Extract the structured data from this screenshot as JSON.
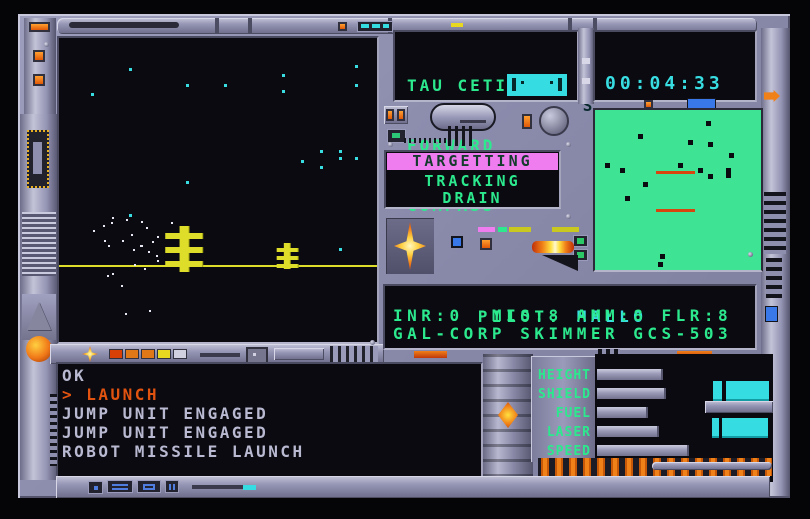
{
  "colors": {
    "metal": "#8e8eae",
    "metal_light": "#c8c8de",
    "metal_dark": "#565672",
    "panel_black": "#0a0a10",
    "green": "#2ce98e",
    "cyan": "#38dde2",
    "radar_green": "#3fe394",
    "pink": "#f07df0",
    "alert_orange": "#e35310",
    "console_gray": "#b9b9d2",
    "yellow": "#dede2a",
    "blue": "#4f7de0"
  },
  "status": {
    "location": "TAU CETI III",
    "view": "FORWARD",
    "compass_label": "COMPASS",
    "compass_heading": "S",
    "clock": "00:04:33",
    "site": "NOVIA",
    "state": "LAUNCHED"
  },
  "target": {
    "mode": "TARGETTING",
    "line1": "TRACKING",
    "line2": "DRAIN"
  },
  "pilot": {
    "label": "PILOT:",
    "name": "MALLO",
    "stats": "INR:0  MIS:8 AMM:8 FLR:8",
    "craft": "GAL-CORP SKIMMER GCS-503"
  },
  "console": {
    "lines": [
      {
        "text": "OK",
        "highlight": false
      },
      {
        "text": "> LAUNCH",
        "highlight": true
      },
      {
        "text": "JUMP UNIT ENGAGED",
        "highlight": false
      },
      {
        "text": "JUMP UNIT ENGAGED",
        "highlight": false
      },
      {
        "text": "ROBOT MISSILE LAUNCH",
        "highlight": false
      }
    ]
  },
  "gauges": [
    {
      "label": "HEIGHT",
      "pct": 56
    },
    {
      "label": "SHIELD",
      "pct": 58
    },
    {
      "label": "FUEL",
      "pct": 43
    },
    {
      "label": "LASER",
      "pct": 52
    },
    {
      "label": "SPEED",
      "pct": 78
    }
  ],
  "radar": {
    "contacts": [
      [
        67,
        7,
        1
      ],
      [
        26,
        15,
        1
      ],
      [
        56,
        19,
        1
      ],
      [
        68,
        20,
        1
      ],
      [
        81,
        27,
        1
      ],
      [
        6,
        33,
        1
      ],
      [
        15,
        36,
        1
      ],
      [
        50,
        33,
        1
      ],
      [
        62,
        36,
        1
      ],
      [
        68,
        40,
        1
      ],
      [
        79,
        36,
        2
      ],
      [
        29,
        45,
        1
      ],
      [
        18,
        54,
        1
      ],
      [
        39,
        90,
        1
      ],
      [
        38,
        95,
        1
      ]
    ],
    "scan_lines": [
      {
        "x": 37,
        "y": 38,
        "w": 23
      },
      {
        "x": 37,
        "y": 62,
        "w": 23
      }
    ]
  },
  "viewport": {
    "horizon_y": 74.8,
    "stars_cyan": [
      [
        22,
        10
      ],
      [
        40,
        15
      ],
      [
        52,
        15
      ],
      [
        70,
        12
      ],
      [
        70,
        17
      ],
      [
        93,
        9
      ],
      [
        93,
        15
      ],
      [
        10,
        18
      ],
      [
        76,
        40
      ],
      [
        82,
        37
      ],
      [
        88,
        37
      ],
      [
        88,
        39
      ],
      [
        82,
        42
      ],
      [
        93,
        39
      ],
      [
        40,
        47
      ],
      [
        22,
        58
      ],
      [
        88,
        69
      ]
    ],
    "stars_white": [
      [
        10.6,
        63
      ],
      [
        13.7,
        61.6
      ],
      [
        16.2,
        60.6
      ],
      [
        16.8,
        59
      ],
      [
        21.2,
        59.7
      ],
      [
        25.9,
        60.3
      ],
      [
        27.4,
        62.3
      ],
      [
        30.8,
        65.2
      ],
      [
        29.3,
        66.8
      ],
      [
        23.4,
        69.4
      ],
      [
        25.5,
        68
      ],
      [
        14.3,
        66.5
      ],
      [
        15.3,
        68
      ],
      [
        19.9,
        66.5
      ],
      [
        22.7,
        64.5
      ],
      [
        25.9,
        68
      ],
      [
        28,
        70
      ],
      [
        30.5,
        71.3
      ],
      [
        23.7,
        74.5
      ],
      [
        26.8,
        75.5
      ],
      [
        15,
        78
      ],
      [
        16.8,
        77.4
      ],
      [
        19.6,
        81.3
      ],
      [
        20.9,
        90.6
      ],
      [
        28.3,
        89.4
      ],
      [
        35.2,
        60.6
      ],
      [
        30.8,
        72.9
      ]
    ],
    "structures": [
      {
        "x": 39.2,
        "top": 62,
        "bot": 77,
        "pole_w": 2.8,
        "arm_w": 11.8,
        "arm_h": 6,
        "arm_ys": [
          64,
          68.7,
          73.2
        ]
      },
      {
        "x": 71.7,
        "top": 67.4,
        "bot": 76,
        "pole_w": 2.0,
        "arm_w": 6.5,
        "arm_h": 4,
        "arm_ys": [
          69,
          71.6,
          74.2
        ]
      }
    ]
  },
  "indicator_squares": [
    "#d84008",
    "#e07818",
    "#e07818",
    "#e8d820",
    "#d0d0e0"
  ]
}
